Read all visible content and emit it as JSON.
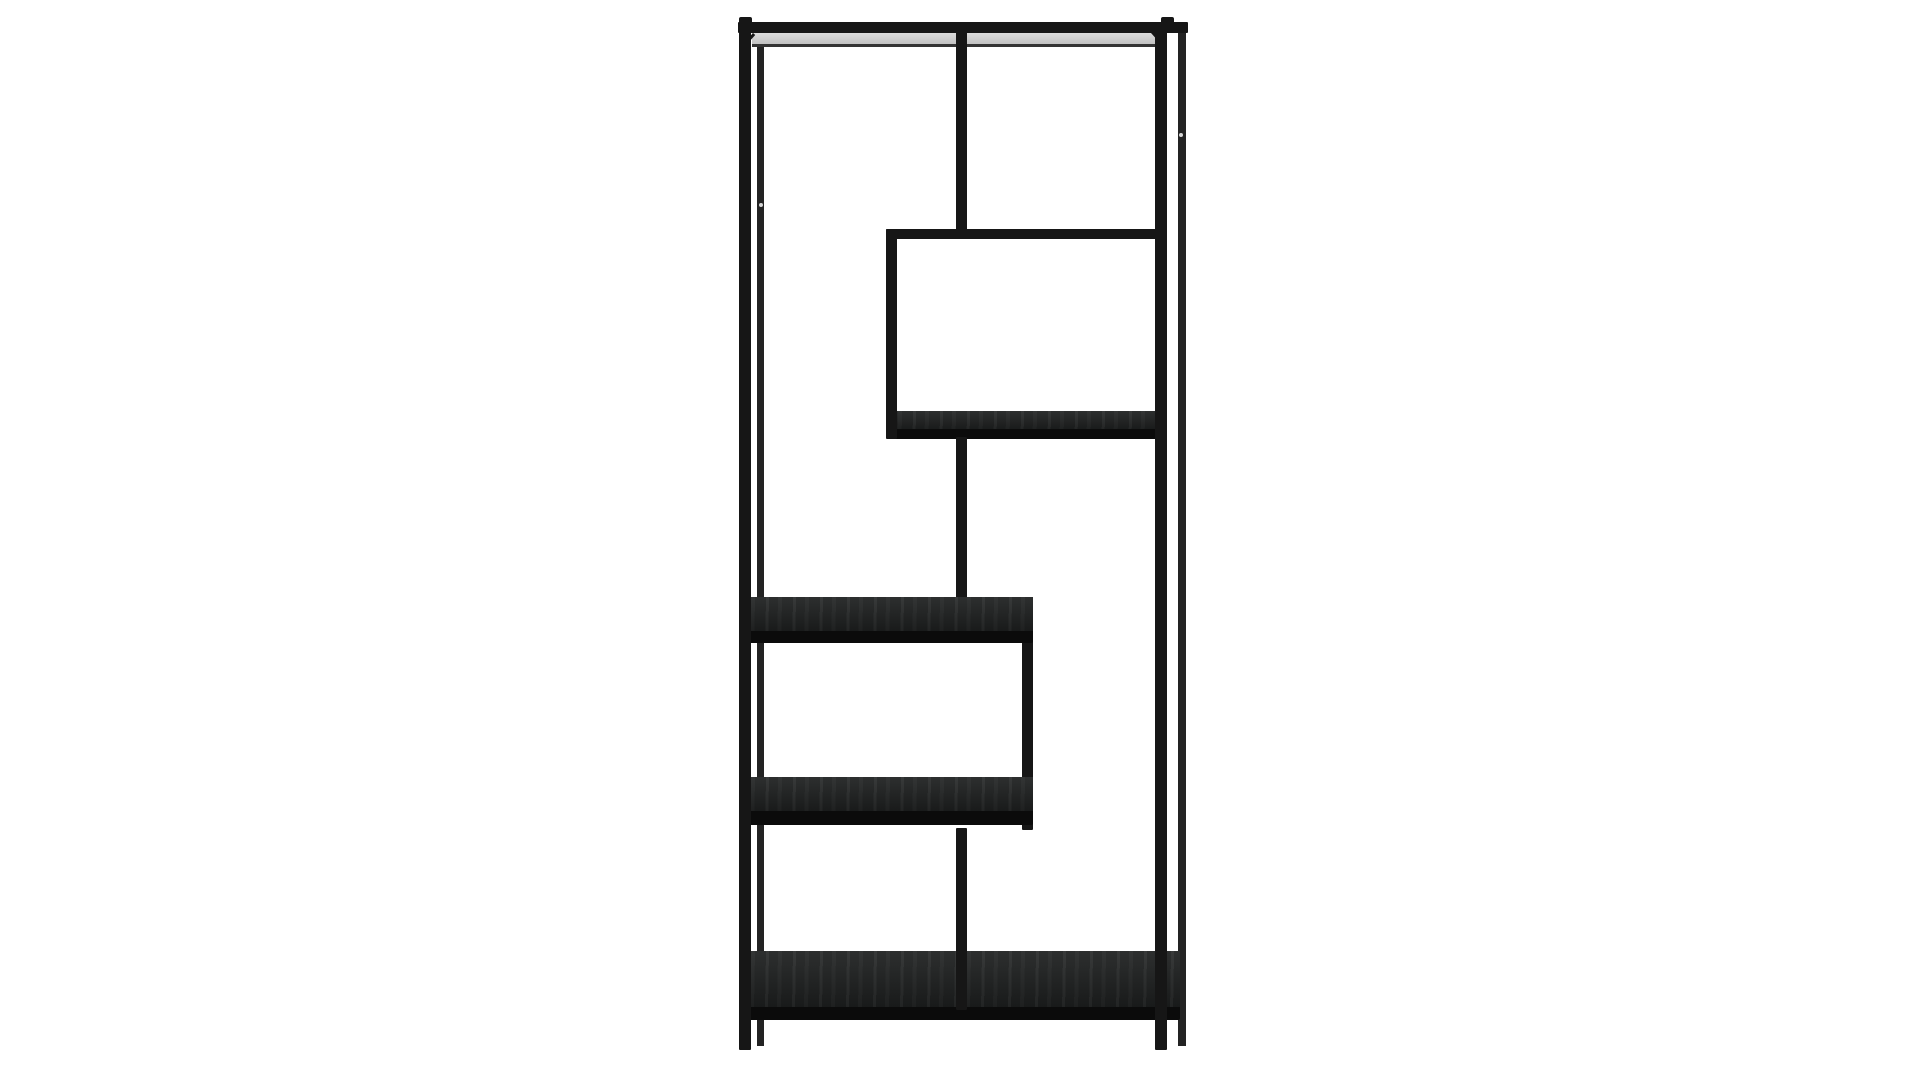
{
  "canvas": {
    "width": 1920,
    "height": 1080,
    "background": "#ffffff"
  },
  "palette": {
    "metal": "#161616",
    "metal_soft": "#232323",
    "wood": "#1d1f1f",
    "wood_lip": "#0b0b0b",
    "underside_light": "#dcdcdc",
    "underside_dark": "#bdbdbd",
    "frame_line": "#343434",
    "dot": "#ebebeb"
  },
  "product": {
    "name": "asymmetric-etagere-bookshelf",
    "description": "Tall black metal open-frame bookcase with staggered shelves, front view, studio white background",
    "parts": [
      {
        "id": "left-back-leg",
        "kind": "metal-thin",
        "x": 757,
        "y": 30,
        "w": 7,
        "h": 1016
      },
      {
        "id": "right-back-leg",
        "kind": "metal-thin",
        "x": 1178,
        "y": 30,
        "w": 8,
        "h": 1016
      },
      {
        "id": "top-shelf-underside",
        "kind": "underside",
        "x": 752,
        "y": 33,
        "w": 403,
        "h": 13
      },
      {
        "id": "top-shelf-seam",
        "kind": "frame-line",
        "x": 752,
        "y": 44,
        "w": 403,
        "h": 3
      },
      {
        "id": "top-left-diagonal",
        "kind": "diag",
        "x": 753,
        "y": 33,
        "w": 3,
        "h": 20,
        "rot": 42
      },
      {
        "id": "top-right-diagonal",
        "kind": "diag",
        "x": 1151,
        "y": 33,
        "w": 3,
        "h": 20,
        "rot": -42
      },
      {
        "id": "top-rail",
        "kind": "metal",
        "x": 738,
        "y": 22,
        "w": 450,
        "h": 11
      },
      {
        "id": "left-post-cap",
        "kind": "cap",
        "x": 739,
        "y": 17,
        "w": 13,
        "h": 6
      },
      {
        "id": "right-post-cap",
        "kind": "cap",
        "x": 1161,
        "y": 17,
        "w": 13,
        "h": 6
      },
      {
        "id": "center-divider-top",
        "kind": "metal",
        "x": 956,
        "y": 28,
        "w": 11,
        "h": 203
      },
      {
        "id": "upper-box-top-rail",
        "kind": "metal",
        "x": 886,
        "y": 229,
        "w": 281,
        "h": 10
      },
      {
        "id": "upper-box-shelf-top",
        "kind": "wood",
        "x": 886,
        "y": 411,
        "w": 281,
        "h": 20
      },
      {
        "id": "upper-box-shelf-lip",
        "kind": "lip",
        "x": 886,
        "y": 429,
        "w": 281,
        "h": 10
      },
      {
        "id": "upper-box-left-edge",
        "kind": "metal",
        "x": 886,
        "y": 229,
        "w": 11,
        "h": 210
      },
      {
        "id": "center-divider-middle",
        "kind": "metal",
        "x": 956,
        "y": 437,
        "w": 11,
        "h": 163
      },
      {
        "id": "lower-box-right-edge",
        "kind": "metal",
        "x": 1022,
        "y": 633,
        "w": 11,
        "h": 197
      },
      {
        "id": "middle-shelf-top",
        "kind": "wood",
        "x": 739,
        "y": 597,
        "w": 294,
        "h": 36
      },
      {
        "id": "middle-shelf-lip",
        "kind": "lip",
        "x": 739,
        "y": 631,
        "w": 294,
        "h": 12
      },
      {
        "id": "lower-shelf-top",
        "kind": "wood",
        "x": 739,
        "y": 777,
        "w": 294,
        "h": 36
      },
      {
        "id": "lower-shelf-lip",
        "kind": "lip",
        "x": 739,
        "y": 811,
        "w": 294,
        "h": 14
      },
      {
        "id": "bottom-shelf-top",
        "kind": "wood",
        "x": 739,
        "y": 951,
        "w": 441,
        "h": 58
      },
      {
        "id": "bottom-shelf-lip",
        "kind": "lip",
        "x": 739,
        "y": 1007,
        "w": 441,
        "h": 13
      },
      {
        "id": "center-divider-bottom",
        "kind": "metal",
        "x": 956,
        "y": 828,
        "w": 11,
        "h": 182
      },
      {
        "id": "left-front-post",
        "kind": "metal",
        "x": 739,
        "y": 22,
        "w": 12,
        "h": 1028
      },
      {
        "id": "right-front-post",
        "kind": "metal",
        "x": 1155,
        "y": 22,
        "w": 12,
        "h": 1028
      },
      {
        "id": "screw-hole-left",
        "kind": "dot",
        "x": 759,
        "y": 203,
        "w": 4,
        "h": 4
      },
      {
        "id": "screw-hole-right",
        "kind": "dot",
        "x": 1179,
        "y": 133,
        "w": 4,
        "h": 4
      }
    ]
  }
}
